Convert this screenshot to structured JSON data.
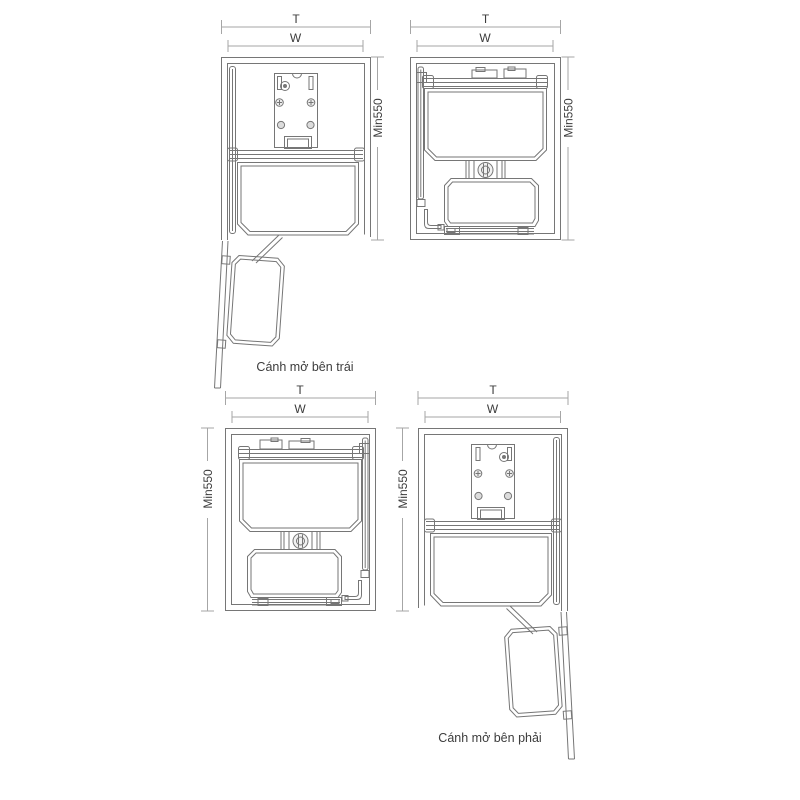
{
  "colors": {
    "drawing_line": "#767676",
    "dimension_line": "#a6a6a6",
    "text": "#3c3c3c",
    "background": "#ffffff"
  },
  "diagrams": {
    "top_left": {
      "top_dim": "T",
      "width_dim": "W",
      "depth_dim": "Min550",
      "caption": "Cánh mở bên trái"
    },
    "top_right": {
      "top_dim": "T",
      "width_dim": "W",
      "depth_dim": "Min550"
    },
    "bottom_left": {
      "top_dim": "T",
      "width_dim": "W",
      "depth_dim": "Min550"
    },
    "bottom_right": {
      "top_dim": "T",
      "width_dim": "W",
      "depth_dim": "Min550",
      "caption": "Cánh mở bên phải"
    }
  }
}
